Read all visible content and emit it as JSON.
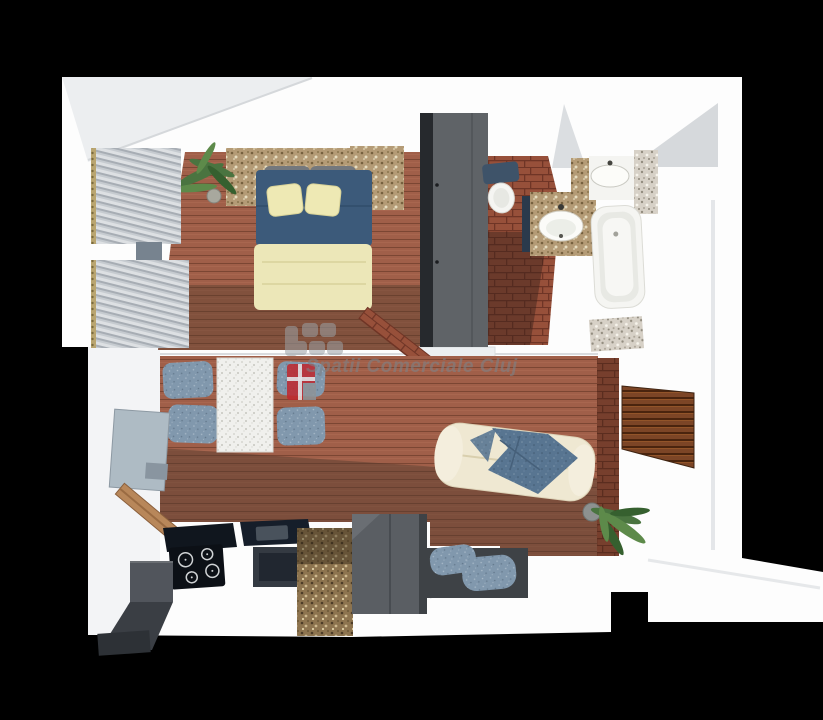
{
  "watermark": {
    "text": "Spatii Comerciale Cluj",
    "text_color": "#7d8287",
    "logo": {
      "icon": "building-blocks-and-red-window-icon",
      "red": "#c0272d",
      "grey": "#9ba1a6",
      "white": "#f2f2f2"
    }
  },
  "scene": {
    "type": "3d-apartment-floor-plan-render",
    "elements": [
      "bedroom",
      "bedroom-bed",
      "bedroom-window-blinds",
      "bedroom-plant",
      "wardrobe",
      "bathroom",
      "toilet",
      "vanity-sink",
      "second-sink",
      "bathtub",
      "dining-table",
      "dining-chairs",
      "tv-panel",
      "living-room",
      "sofa",
      "wood-accent-panel",
      "living-plant",
      "floor-cushions",
      "kitchen-counter",
      "cooktop",
      "oven",
      "granite-column",
      "fridge-cabinet",
      "entry-ramp",
      "hallway"
    ]
  },
  "palette": {
    "background": "#000000",
    "walls": "#fdfdfd",
    "wood_floor": "#a05f49",
    "wood_floor_dark": "#4f392c",
    "brick_tile": "#97503a",
    "stone_tan": "#b49b76",
    "stone_grey": "#d7d1c7",
    "granite_brown": "#8d744f",
    "bed_blue": "#3c5a7a",
    "bed_cream": "#ece7b8",
    "chair_blue": "#8198ad",
    "sofa_cream": "#efe8d2",
    "sofa_throw_blue": "#587591",
    "wardrobe_grey": "#5f6367",
    "counter_black": "#10161e",
    "plant_green": "#4a7440"
  }
}
